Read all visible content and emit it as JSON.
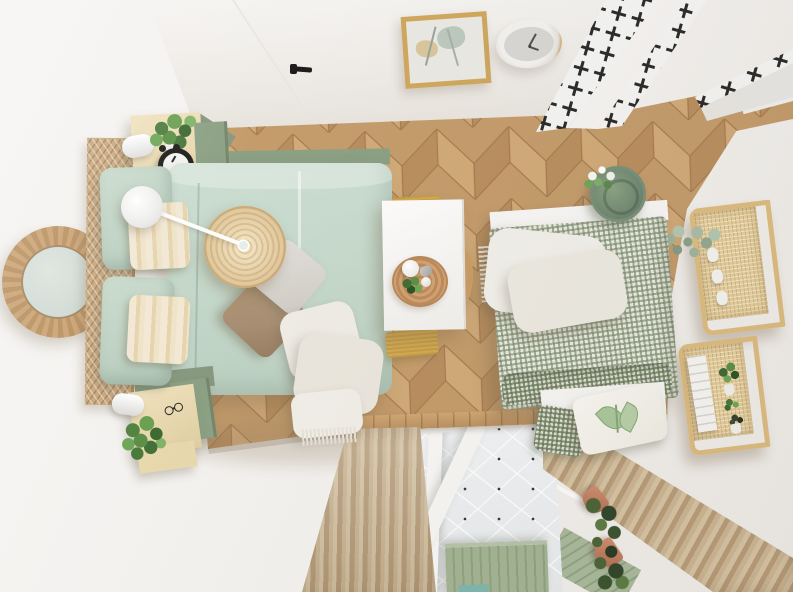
{
  "meta": {
    "title": "Top-down 3D render of a scandinavian style bedroom",
    "width_px": 793,
    "height_px": 592
  },
  "palette": {
    "wall": "#f6f4f2",
    "floorBase": "#c49c6c",
    "floorLight": "#d1aa79",
    "floorDark": "#b98f60",
    "floorSeam": "#a67c50",
    "tileWhite": "#f4f4f2",
    "tileBlack": "#2e2c2b",
    "mint": "#c6d9cb",
    "mintDeep": "#b4cabb",
    "sage": "#8ca184",
    "gingham": "#9aa58e",
    "cream": "#ecddb6",
    "rattan": "#c9a87e",
    "rattanLight": "#ecd9b4",
    "taupe": "#a88f73",
    "blanket": "#eeebe3",
    "mustard": "#d5ab52",
    "curtainLight": "#d6c3a3",
    "curtainDark": "#b79c78",
    "terracotta": "#c5826a",
    "foliage": "#5f8f4d",
    "foliageDark": "#3c5430",
    "eucalyptus": "#a9bda7",
    "glass": "#cfd9d3",
    "gold": "#c9a76b",
    "radiator": "#a3b493"
  },
  "scene": {
    "style": "top-down interior render, no visible text",
    "floor": "herringbone oak",
    "walls": "white",
    "objects": [
      {
        "name": "round-rattan-mirror",
        "position": "left wall"
      },
      {
        "name": "cane-bed-headboard",
        "material": "woven cane"
      },
      {
        "name": "bed",
        "bedding": "mint green duvet",
        "pillows": [
          "mint large x2",
          "striped cream x2",
          "light grey",
          "taupe"
        ],
        "extras": [
          "white crumpled throw with fringe"
        ]
      },
      {
        "name": "rattan-pendant-shade"
      },
      {
        "name": "white-sphere-lamp",
        "detail": "thin white arm over bed"
      },
      {
        "name": "nightstand-top",
        "items": [
          "white cylinder lamp",
          "potted plant",
          "black alarm clock"
        ],
        "colors": [
          "cream",
          "sage"
        ]
      },
      {
        "name": "nightstand-bottom",
        "items": [
          "white cylinder lamp",
          "potted plant",
          "reading glasses"
        ],
        "colors": [
          "cream",
          "sage"
        ]
      },
      {
        "name": "white-desk",
        "items": [
          "round rattan tray",
          "white cup",
          "small plant",
          "white decor ball",
          "metal creamer"
        ],
        "rug": "mustard fringed runner"
      },
      {
        "name": "wooden-chair"
      },
      {
        "name": "daybed",
        "mattress": "sage gingham check",
        "base": "white",
        "items": [
          "green ceramic planter with white flowers",
          "white fringed throw",
          "botanical leaf pillow",
          "gingham pillow"
        ]
      },
      {
        "name": "wall-shelf-upper",
        "material": "rattan",
        "items": [
          "eucalyptus sprigs",
          "white vases"
        ]
      },
      {
        "name": "wall-shelf-lower",
        "material": "rattan",
        "items": [
          "white books",
          "potted plants",
          "dark cactus"
        ]
      },
      {
        "name": "wall-clock",
        "detail": "white and gold rim, grey face"
      },
      {
        "name": "framed-botanical-art",
        "frame": "light wood"
      },
      {
        "name": "black-door-handle"
      },
      {
        "name": "entry-tile-floor",
        "pattern": "black cross stars on white"
      },
      {
        "name": "curtain-left",
        "color": "beige pleated"
      },
      {
        "name": "curtain-right-diagonal",
        "color": "beige pleated"
      },
      {
        "name": "wood-floor-trim"
      },
      {
        "name": "loft-opening",
        "below": [
          "white tiled wall with dots",
          "white lattice window frame",
          "green radiator",
          "white railing",
          "terracotta trailing planters"
        ]
      }
    ]
  }
}
